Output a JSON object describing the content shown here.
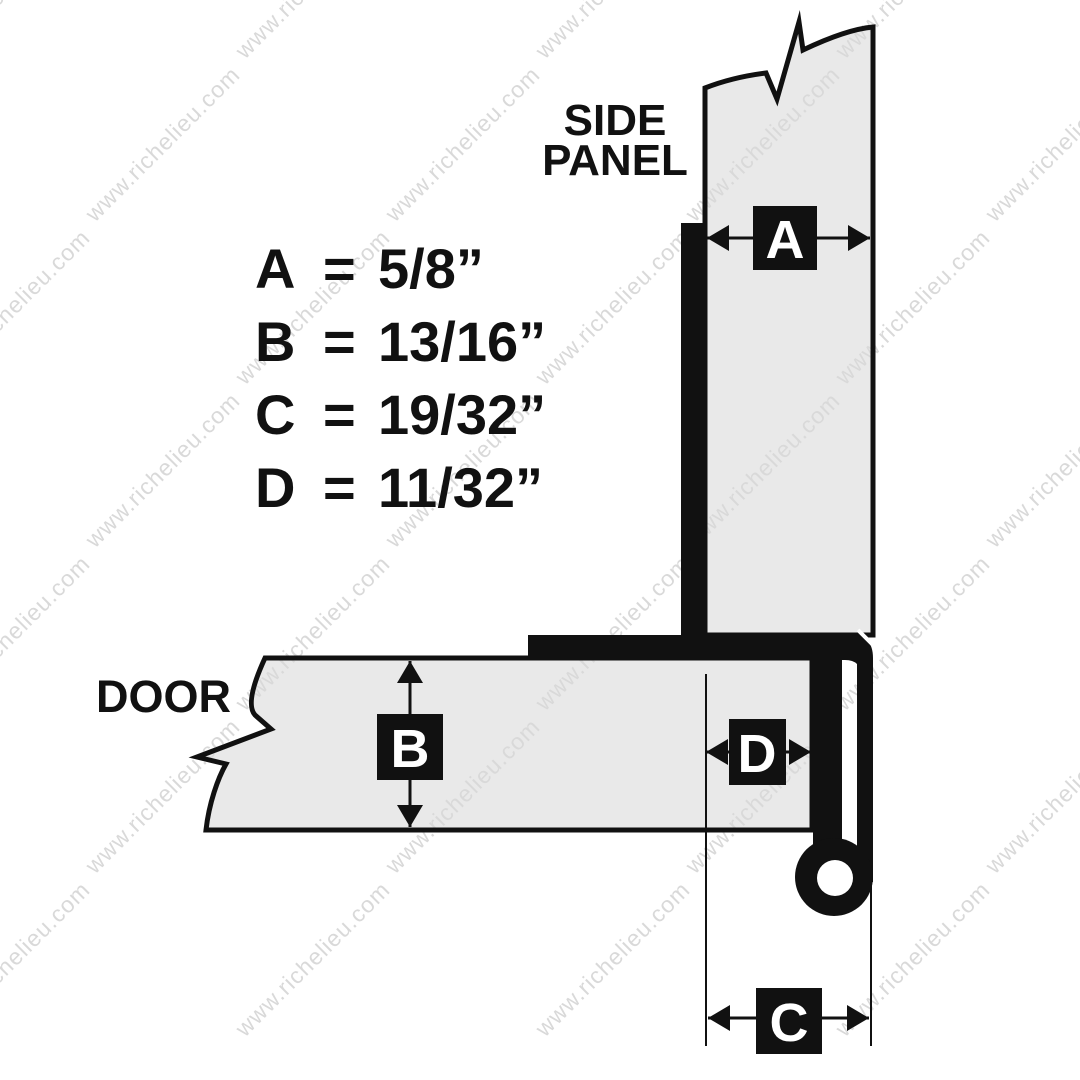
{
  "labels": {
    "side_panel_line1": "SIDE",
    "side_panel_line2": "PANEL",
    "door": "DOOR"
  },
  "equals_sign": "=",
  "dimensions": [
    {
      "key": "A",
      "value": "5/8”"
    },
    {
      "key": "B",
      "value": "13/16”"
    },
    {
      "key": "C",
      "value": "19/32”"
    },
    {
      "key": "D",
      "value": "11/32”"
    }
  ],
  "watermark": {
    "text": "www.richelieu.com",
    "color": "#d9d9d9"
  },
  "colors": {
    "background": "#ffffff",
    "panel_fill": "#e9e9e9",
    "ink": "#111111",
    "marker_text": "#ffffff"
  }
}
